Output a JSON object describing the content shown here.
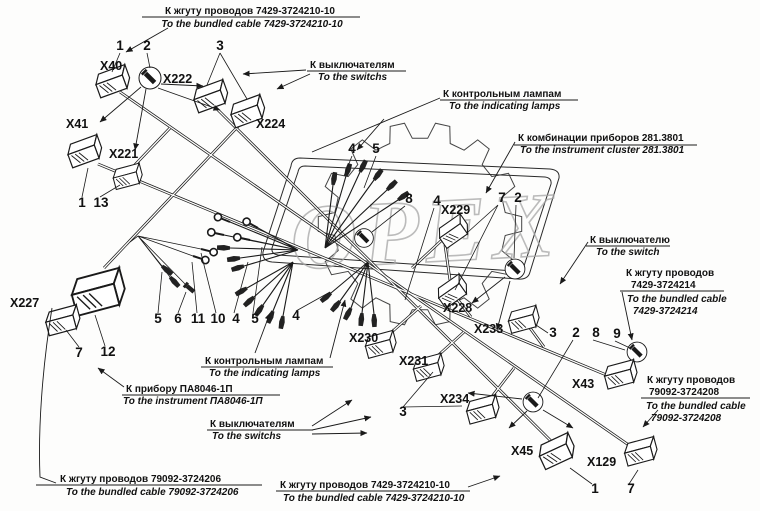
{
  "watermark": "OPEX",
  "callouts": {
    "top_ru": "К жгуту проводов 7429-3724210-10",
    "top_en": "To the bundled cable 7429-3724210-10",
    "switches_top_ru": "К выключателям",
    "switches_top_en": "To the switchs",
    "lamps_top_ru": "К контрольным лампам",
    "lamps_top_en": "To the indicating lamps",
    "cluster_ru": "К комбинации приборов 281.3801",
    "cluster_en": "To the instrument cluster 281.3801",
    "switch_right_ru": "К выключателю",
    "switch_right_en": "To the switch",
    "cable214_ru1": "К жгуту проводов",
    "cable214_ru2": "7429-3724214",
    "cable214_en1": "To the bundled cable",
    "cable214_en2": "7429-3724214",
    "cable208_ru1": "К жгуту проводов",
    "cable208_ru2": "79092-3724208",
    "cable208_en1": "To the bundled cable",
    "cable208_en2": "79092-3724208",
    "lamps_bottom_ru": "К контрольным лампам",
    "lamps_bottom_en": "To the indicating lamps",
    "instrument_ru": "К прибору ПА8046-1П",
    "instrument_en": "To the instrument ПА8046-1П",
    "switches_bottom_ru": "К выключателям",
    "switches_bottom_en": "To the switchs",
    "cable206_ru": "К жгуту проводов 79092-3724206",
    "cable206_en": "To the bundled cable 79092-3724206",
    "cable210b_ru": "К жгуту проводов 7429-3724210-10",
    "cable210b_en": "To the bundled cable 7429-3724210-10"
  },
  "connectors": {
    "x40": "X40",
    "x41": "X41",
    "x221": "X221",
    "x222": "X222",
    "x224": "X224",
    "x227": "X227",
    "x228": "X228",
    "x229": "X229",
    "x230": "X230",
    "x231": "X231",
    "x233": "X233",
    "x234": "X234",
    "x43": "X43",
    "x45": "X45",
    "x129": "X129"
  },
  "numbers": [
    "1",
    "2",
    "3",
    "1",
    "13",
    "4",
    "5",
    "8",
    "4",
    "7",
    "2",
    "7",
    "12",
    "5",
    "6",
    "11",
    "10",
    "4",
    "5",
    "4",
    "3",
    "3",
    "2",
    "8",
    "9",
    "1",
    "7"
  ]
}
